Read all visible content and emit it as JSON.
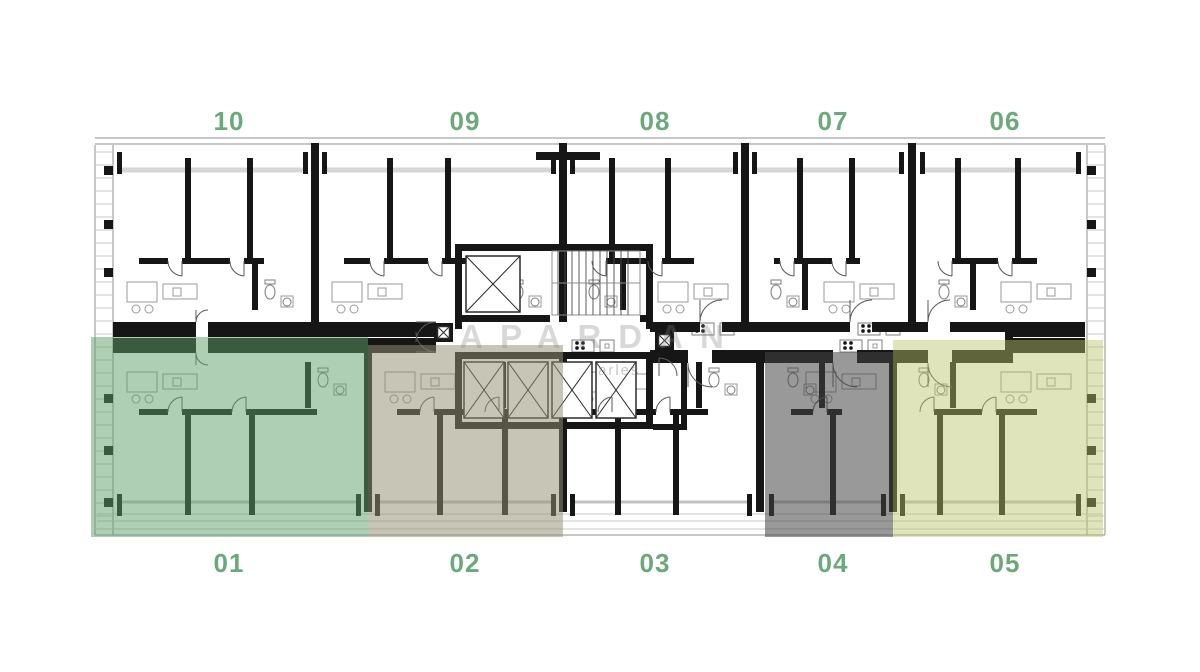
{
  "page": {
    "background": "#ffffff"
  },
  "watermark": {
    "title": "APARDAN",
    "subtitle_fragment": "arles"
  },
  "label_color": "#6BA87A",
  "units": {
    "top": [
      {
        "id": "10",
        "label": "10"
      },
      {
        "id": "09",
        "label": "09"
      },
      {
        "id": "08",
        "label": "08"
      },
      {
        "id": "07",
        "label": "07"
      },
      {
        "id": "06",
        "label": "06"
      }
    ],
    "bottom": [
      {
        "id": "01",
        "label": "01"
      },
      {
        "id": "02",
        "label": "02"
      },
      {
        "id": "03",
        "label": "03"
      },
      {
        "id": "04",
        "label": "04"
      },
      {
        "id": "05",
        "label": "05"
      }
    ]
  },
  "overlays": [
    {
      "unit": "01",
      "color": "rgba(96,160,108,0.50)"
    },
    {
      "unit": "02",
      "color": "rgba(147,144,115,0.52)"
    },
    {
      "unit": "04",
      "color": "rgba(70,70,70,0.55)"
    },
    {
      "unit": "05",
      "color": "rgba(183,196,105,0.45)"
    }
  ]
}
